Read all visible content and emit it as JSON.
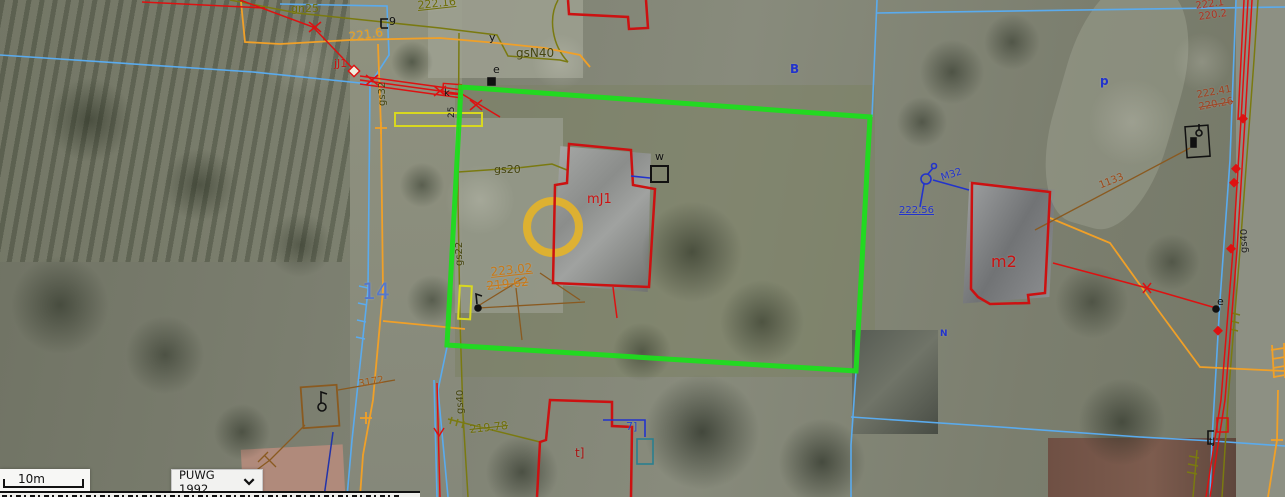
{
  "controls": {
    "scale_bar_label": "10m",
    "projection_value": "PUWG 1992"
  },
  "colors": {
    "highlight_green": "#1ddd1d",
    "parcel_cyan": "#5aabee",
    "utility_orange": "#f0a028",
    "survey_yellow": "#d8d820",
    "gas_olive": "#7a7a10",
    "building_red": "#cc1111",
    "annotation_blue": "#2233cc",
    "marker_gold": "#e6b428"
  },
  "map_labels": [
    {
      "t": "gn25",
      "x": 291,
      "y": 3,
      "c": "#6e6e08",
      "s": 11
    },
    {
      "t": "222.16",
      "x": 417,
      "y": 0,
      "c": "#6e6e08",
      "s": 11,
      "u": 1,
      "r": -6
    },
    {
      "t": "gsN40",
      "x": 516,
      "y": 47,
      "c": "#454510",
      "s": 12
    },
    {
      "t": "gs20",
      "x": 494,
      "y": 164,
      "c": "#454510",
      "s": 11
    },
    {
      "t": "gs22",
      "x": 455,
      "y": 266,
      "c": "#454510",
      "s": 10,
      "r": -90
    },
    {
      "t": "gs32",
      "x": 378,
      "y": 106,
      "c": "#454510",
      "s": 10,
      "r": -90
    },
    {
      "t": "gs40",
      "x": 456,
      "y": 414,
      "c": "#454510",
      "s": 10,
      "r": -90
    },
    {
      "t": "gs40",
      "x": 1240,
      "y": 253,
      "c": "#222222",
      "s": 10,
      "r": -90
    },
    {
      "t": "219.78",
      "x": 469,
      "y": 424,
      "c": "#6e6e08",
      "s": 11,
      "st": 1,
      "r": -6
    },
    {
      "t": "221.6",
      "x": 348,
      "y": 31,
      "c": "#e8a020",
      "s": 12,
      "r": -8
    },
    {
      "t": "223.02",
      "x": 490,
      "y": 266,
      "c": "#c87818",
      "s": 12,
      "u": 1,
      "r": -6
    },
    {
      "t": "219.62",
      "x": 486,
      "y": 280,
      "c": "#c87818",
      "s": 12,
      "st": 1,
      "r": -6
    },
    {
      "t": "3172",
      "x": 358,
      "y": 380,
      "c": "#a05818",
      "s": 10,
      "r": -10
    },
    {
      "t": "1133",
      "x": 1098,
      "y": 182,
      "c": "#a04818",
      "s": 10,
      "r": -22
    },
    {
      "t": "222.41",
      "x": 1196,
      "y": 91,
      "c": "#a04020",
      "s": 10,
      "r": -10
    },
    {
      "t": "220.26",
      "x": 1198,
      "y": 103,
      "c": "#a04020",
      "s": 10,
      "r": -10,
      "st": 1
    },
    {
      "t": "222.1",
      "x": 1195,
      "y": 2,
      "c": "#b03020",
      "s": 10,
      "r": -8
    },
    {
      "t": "220.2",
      "x": 1198,
      "y": 13,
      "c": "#b03020",
      "s": 10,
      "r": -8
    },
    {
      "t": "jJ1",
      "x": 334,
      "y": 58,
      "c": "#cc1111",
      "s": 11
    },
    {
      "t": "mJ1",
      "x": 587,
      "y": 193,
      "c": "#cc1111",
      "s": 13
    },
    {
      "t": "m2",
      "x": 991,
      "y": 254,
      "c": "#cc1111",
      "s": 16
    },
    {
      "t": "t]",
      "x": 575,
      "y": 447,
      "c": "#aa1111",
      "s": 12
    },
    {
      "t": "14",
      "x": 362,
      "y": 282,
      "c": "#5577cc",
      "s": 22
    },
    {
      "t": "B",
      "x": 790,
      "y": 63,
      "c": "#2233cc",
      "s": 12,
      "b": 1
    },
    {
      "t": "p",
      "x": 1100,
      "y": 75,
      "c": "#2233cc",
      "s": 12,
      "b": 1
    },
    {
      "t": "M32",
      "x": 940,
      "y": 174,
      "c": "#2233cc",
      "s": 10,
      "r": -18
    },
    {
      "t": "222.56",
      "x": 899,
      "y": 206,
      "c": "#2233cc",
      "s": 10,
      "u": 1
    },
    {
      "t": "N",
      "x": 940,
      "y": 330,
      "c": "#2233cc",
      "s": 9,
      "b": 1
    },
    {
      "t": "7]",
      "x": 626,
      "y": 421,
      "c": "#2244cc",
      "s": 11
    },
    {
      "t": "y",
      "x": 489,
      "y": 32,
      "c": "#111111",
      "s": 11
    },
    {
      "t": "e",
      "x": 493,
      "y": 64,
      "c": "#111111",
      "s": 11
    },
    {
      "t": "k",
      "x": 444,
      "y": 89,
      "c": "#111111",
      "s": 10
    },
    {
      "t": "w",
      "x": 655,
      "y": 151,
      "c": "#111111",
      "s": 11
    },
    {
      "t": "e",
      "x": 1217,
      "y": 296,
      "c": "#111111",
      "s": 11
    },
    {
      "t": "tJ",
      "x": 1209,
      "y": 438,
      "c": "#111111",
      "s": 9
    },
    {
      "t": "9",
      "x": 389,
      "y": 16,
      "c": "#111111",
      "s": 11
    },
    {
      "t": "25",
      "x": 448,
      "y": 118,
      "c": "#111111",
      "s": 9,
      "r": -90
    }
  ]
}
